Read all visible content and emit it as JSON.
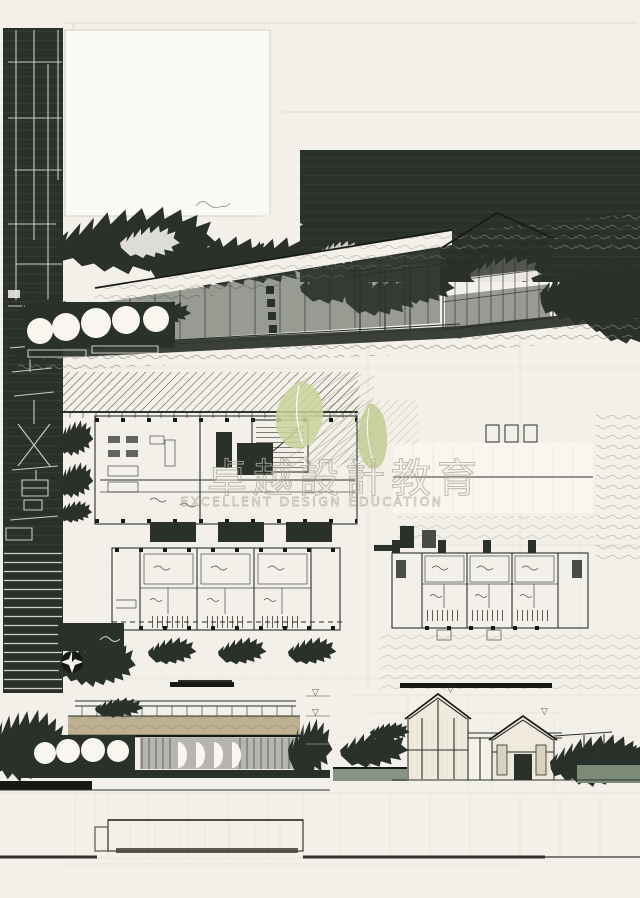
{
  "board": {
    "type": "hand-drawn architectural presentation board",
    "watermark": {
      "text_cn": "卓越設計教育",
      "text_en": "EXCELLENT DESIGN EDUCATION"
    },
    "symbols": {
      "water_level": "▽"
    }
  },
  "colors": {
    "paper": "#f2f0e9",
    "ink": "#2a302a",
    "inkdeep": "#161a13",
    "pencil": "#8d8a7c",
    "pencil2": "#c3bfae",
    "tan": "#b7aa88",
    "green": "#9aa562",
    "leaf": "#cbd49c",
    "leaf2": "#c0ca8e",
    "water": "#7c8a78",
    "wm": "#b1afa2",
    "wline": "#eae8dc"
  }
}
